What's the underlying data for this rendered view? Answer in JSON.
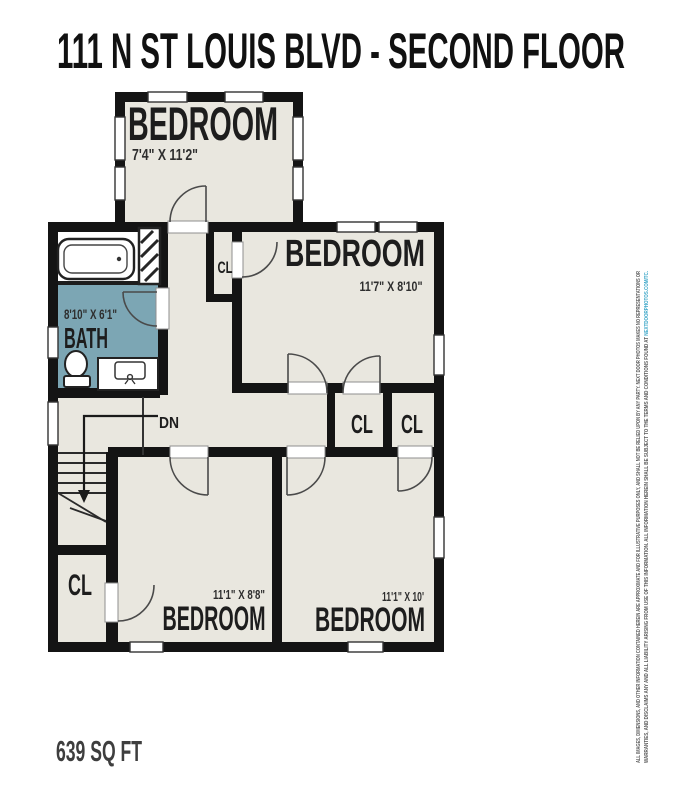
{
  "title": "111 N ST LOUIS BLVD - SECOND FLOOR",
  "area": "639 SQ FT",
  "rooms": {
    "bedroom_top": {
      "name": "BEDROOM",
      "dims": "7'4\" X 11'2\""
    },
    "bedroom_mid": {
      "name": "BEDROOM",
      "dims": "11'7\" X 8'10\""
    },
    "bedroom_bl": {
      "name": "BEDROOM",
      "dims": "11'1\" X 8'8\""
    },
    "bedroom_br": {
      "name": "BEDROOM",
      "dims": "11'1\" X 10'"
    },
    "bath": {
      "name": "BATH",
      "dims": "8'10\" X 6'1\""
    }
  },
  "closets": {
    "hall": "CL",
    "mid_left": "CL",
    "mid_right": "CL",
    "bottom_left": "CL"
  },
  "stairs": {
    "down": "DN"
  },
  "disclaimer": {
    "line1": "ALL IMAGES, DIMENSIONS, AND OTHER INFORMATION CONTAINED HEREIN ARE APPROXIMATE AND FOR ILLUSTRATIVE PURPOSES ONLY, AND SHALL NOT BE RELIED UPON BY ANY PARTY. NEXT DOOR PHOTOS MAKES NO REPRESENTATIONS OR",
    "line2": "WARRANTIES, AND DISCLAIMS ANY AND ALL LIABILITY ARISING FROM USE OF THIS INFORMATION. ALL INFORMATION HEREIN SHALL BE SUBJECT TO THE TERMS AND CONDITIONS FOUND AT ",
    "link": "NEXTDOORPHOTOS.COM/TC."
  },
  "colors": {
    "wall": "#141414",
    "floor": "#e9e7df",
    "bath_floor": "#7ca6b4",
    "link": "#3fa8c9",
    "label": "#1d1d1d",
    "muted_label": "#3e3e3e"
  }
}
